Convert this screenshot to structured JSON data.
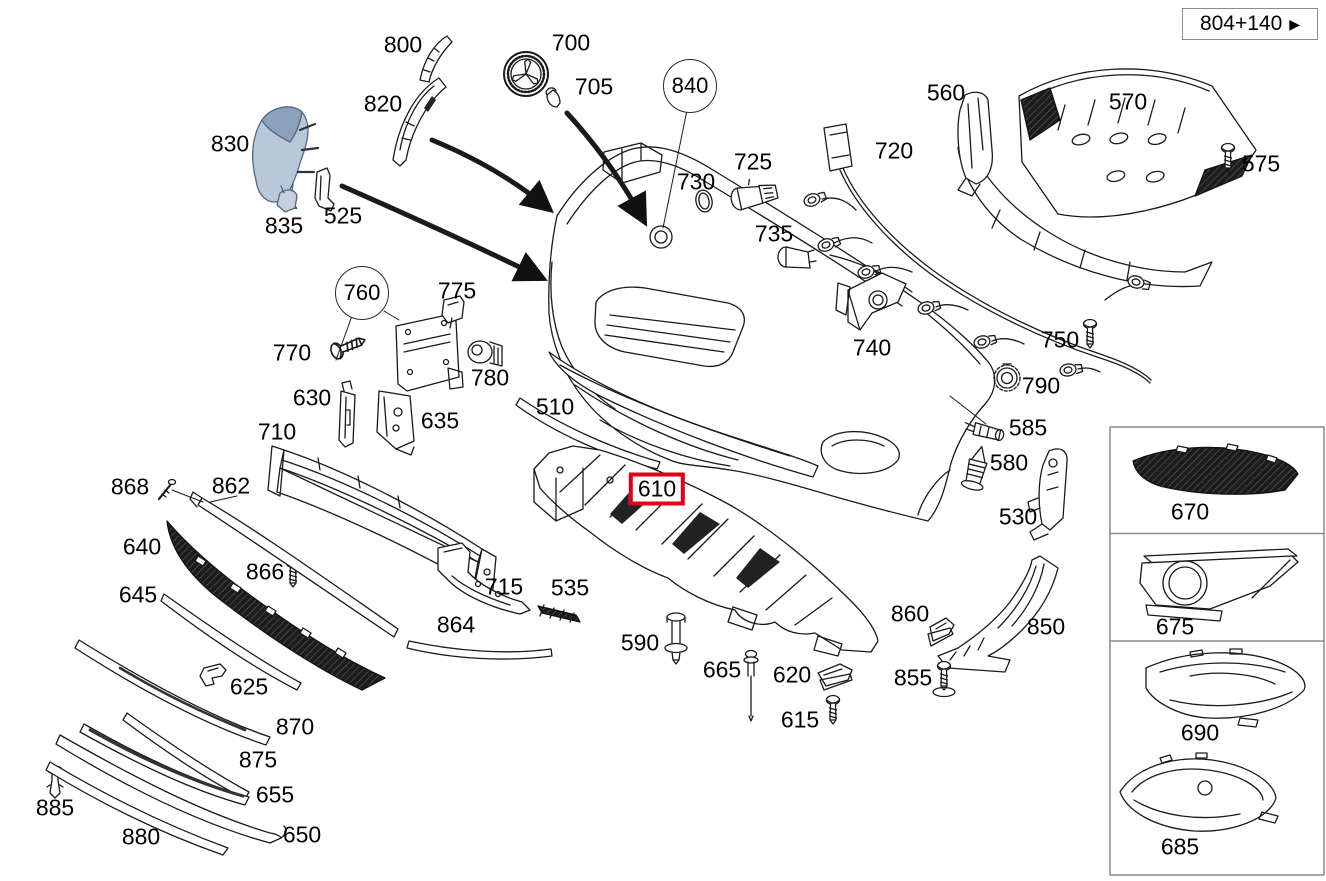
{
  "title": "Front bumper exploded parts diagram",
  "reference": {
    "text": "804+140",
    "arrow_icon": "▶"
  },
  "colors": {
    "highlight": "#e2001a",
    "ink": "#1a1a1a",
    "panel_border": "#8a8a8a",
    "mesh_dark": "#1c1c1c",
    "shaded_part_fill": "#b9c7da",
    "shaded_part_top": "#8ba0ba"
  },
  "highlighted_part": "610",
  "circled_parts": [
    "760",
    "840"
  ],
  "diagram": {
    "labels": [
      {
        "id": "800",
        "x": 403,
        "y": 45
      },
      {
        "id": "820",
        "x": 383,
        "y": 104
      },
      {
        "id": "830",
        "x": 230,
        "y": 144
      },
      {
        "id": "835",
        "x": 284,
        "y": 226
      },
      {
        "id": "525",
        "x": 343,
        "y": 216
      },
      {
        "id": "700",
        "x": 571,
        "y": 43
      },
      {
        "id": "705",
        "x": 594,
        "y": 87
      },
      {
        "id": "840",
        "x": 690,
        "y": 86,
        "variant": "circled"
      },
      {
        "id": "730",
        "x": 696,
        "y": 182
      },
      {
        "id": "725",
        "x": 753,
        "y": 162
      },
      {
        "id": "735",
        "x": 774,
        "y": 234
      },
      {
        "id": "720",
        "x": 894,
        "y": 151
      },
      {
        "id": "560",
        "x": 946,
        "y": 93
      },
      {
        "id": "570",
        "x": 1128,
        "y": 102
      },
      {
        "id": "575",
        "x": 1261,
        "y": 164
      },
      {
        "id": "740",
        "x": 872,
        "y": 348
      },
      {
        "id": "750",
        "x": 1060,
        "y": 340
      },
      {
        "id": "790",
        "x": 1041,
        "y": 386
      },
      {
        "id": "585",
        "x": 1028,
        "y": 428
      },
      {
        "id": "580",
        "x": 1009,
        "y": 463
      },
      {
        "id": "530",
        "x": 1018,
        "y": 517
      },
      {
        "id": "760",
        "x": 362,
        "y": 293,
        "variant": "circled"
      },
      {
        "id": "775",
        "x": 457,
        "y": 291
      },
      {
        "id": "770",
        "x": 292,
        "y": 353
      },
      {
        "id": "780",
        "x": 490,
        "y": 378
      },
      {
        "id": "630",
        "x": 312,
        "y": 398
      },
      {
        "id": "635",
        "x": 440,
        "y": 421
      },
      {
        "id": "710",
        "x": 277,
        "y": 432
      },
      {
        "id": "510",
        "x": 555,
        "y": 407
      },
      {
        "id": "868",
        "x": 130,
        "y": 487
      },
      {
        "id": "862",
        "x": 231,
        "y": 486
      },
      {
        "id": "640",
        "x": 142,
        "y": 547
      },
      {
        "id": "866",
        "x": 265,
        "y": 572
      },
      {
        "id": "645",
        "x": 138,
        "y": 595
      },
      {
        "id": "610",
        "x": 657,
        "y": 489,
        "variant": "boxed"
      },
      {
        "id": "715",
        "x": 504,
        "y": 587
      },
      {
        "id": "535",
        "x": 570,
        "y": 588
      },
      {
        "id": "864",
        "x": 456,
        "y": 625
      },
      {
        "id": "625",
        "x": 249,
        "y": 687
      },
      {
        "id": "590",
        "x": 640,
        "y": 643
      },
      {
        "id": "665",
        "x": 722,
        "y": 670
      },
      {
        "id": "620",
        "x": 792,
        "y": 675
      },
      {
        "id": "615",
        "x": 800,
        "y": 720
      },
      {
        "id": "860",
        "x": 910,
        "y": 614
      },
      {
        "id": "850",
        "x": 1046,
        "y": 627
      },
      {
        "id": "855",
        "x": 913,
        "y": 678
      },
      {
        "id": "870",
        "x": 295,
        "y": 727
      },
      {
        "id": "875",
        "x": 258,
        "y": 760
      },
      {
        "id": "655",
        "x": 275,
        "y": 795
      },
      {
        "id": "885",
        "x": 55,
        "y": 808
      },
      {
        "id": "880",
        "x": 141,
        "y": 837
      },
      {
        "id": "650",
        "x": 302,
        "y": 835
      },
      {
        "id": "670",
        "x": 1190,
        "y": 512
      },
      {
        "id": "675",
        "x": 1175,
        "y": 627
      },
      {
        "id": "690",
        "x": 1200,
        "y": 733
      },
      {
        "id": "685",
        "x": 1180,
        "y": 847
      }
    ]
  }
}
